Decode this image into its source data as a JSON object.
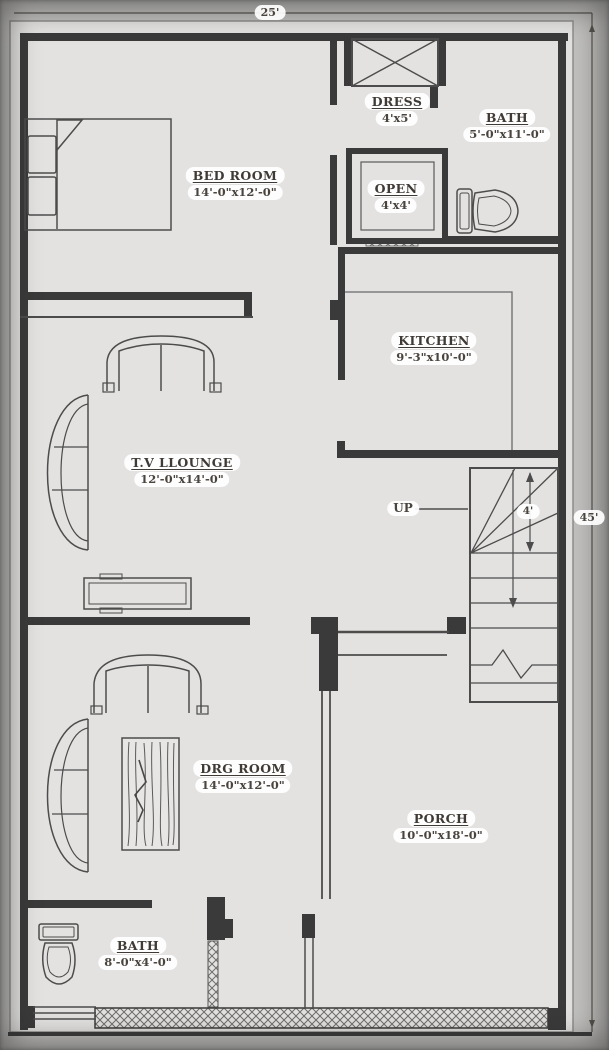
{
  "plan": {
    "dimensions": {
      "width": "25'",
      "depth": "45'",
      "stair_width": "4'"
    },
    "rooms": [
      {
        "name": "BED ROOM",
        "size": "14'-0\"x12'-0\""
      },
      {
        "name": "DRESS",
        "size": "4'x5'"
      },
      {
        "name": "BATH",
        "size": "5'-0\"x11'-0\""
      },
      {
        "name": "OPEN",
        "size": "4'x4'"
      },
      {
        "name": "KITCHEN",
        "size": "9'-3\"x10'-0\""
      },
      {
        "name": "T.V LLOUNGE",
        "size": "12'-0\"x14'-0\""
      },
      {
        "name": "DRG ROOM",
        "size": "14'-0\"x12'-0\""
      },
      {
        "name": "PORCH",
        "size": "10'-0\"x18'-0\""
      },
      {
        "name": "BATH",
        "size": "8'-0\"x4'-0\""
      }
    ],
    "stairs": {
      "label": "UP"
    },
    "colors": {
      "wall": "#3a3a3a",
      "line": "#4c4c4c",
      "floor": "#e3e2e0",
      "margin": "#c2c1bf",
      "label_text": "#3f3a35",
      "label_bg": "#ffffff"
    }
  }
}
